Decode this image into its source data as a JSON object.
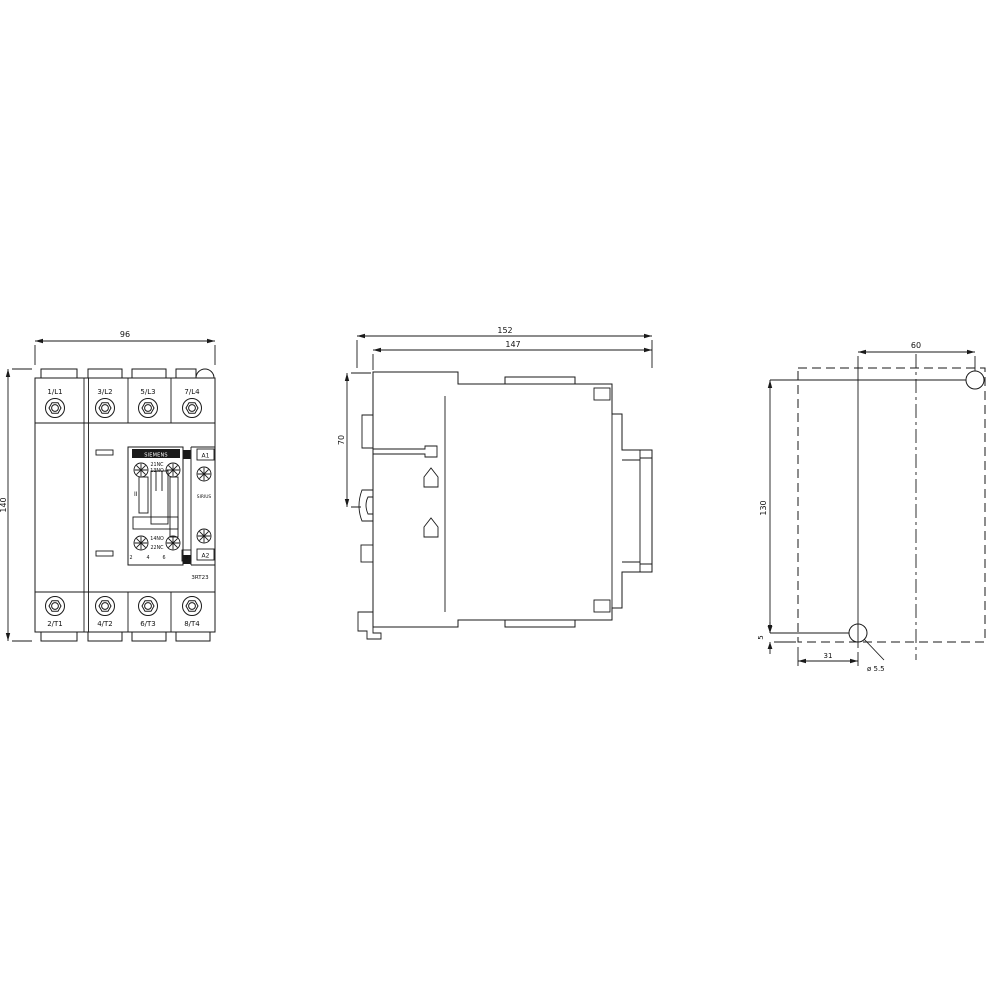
{
  "front_view": {
    "width_dim": "96",
    "height_dim": "140",
    "top_terminals": [
      "1/L1",
      "3/L2",
      "5/L3",
      "7/L4"
    ],
    "bottom_terminals": [
      "2/T1",
      "4/T2",
      "6/T3",
      "8/T4"
    ],
    "brand": "SIEMENS",
    "series": "SIRIUS",
    "model": "3RT23",
    "aux_top_nc": "21NC",
    "aux_top_no": "13NO",
    "aux_bottom_no": "14NO",
    "aux_bottom_nc": "22NC",
    "coil_a1": "A1",
    "coil_a2": "A2",
    "pole_digits": [
      "2",
      "4",
      "6",
      "8"
    ],
    "size_marking": "II"
  },
  "side_view": {
    "overall_depth_dim": "152",
    "body_depth_dim": "147",
    "rail_section_dim": "70"
  },
  "mounting_view": {
    "hole_pitch_h_dim": "60",
    "hole_pitch_v_dim": "130",
    "hole_edge_bottom_dim": "5",
    "hole_edge_side_dim": "31",
    "hole_dia_label": "ø 5.5"
  },
  "colors": {
    "line": "#1a1a1a",
    "background": "#ffffff"
  }
}
